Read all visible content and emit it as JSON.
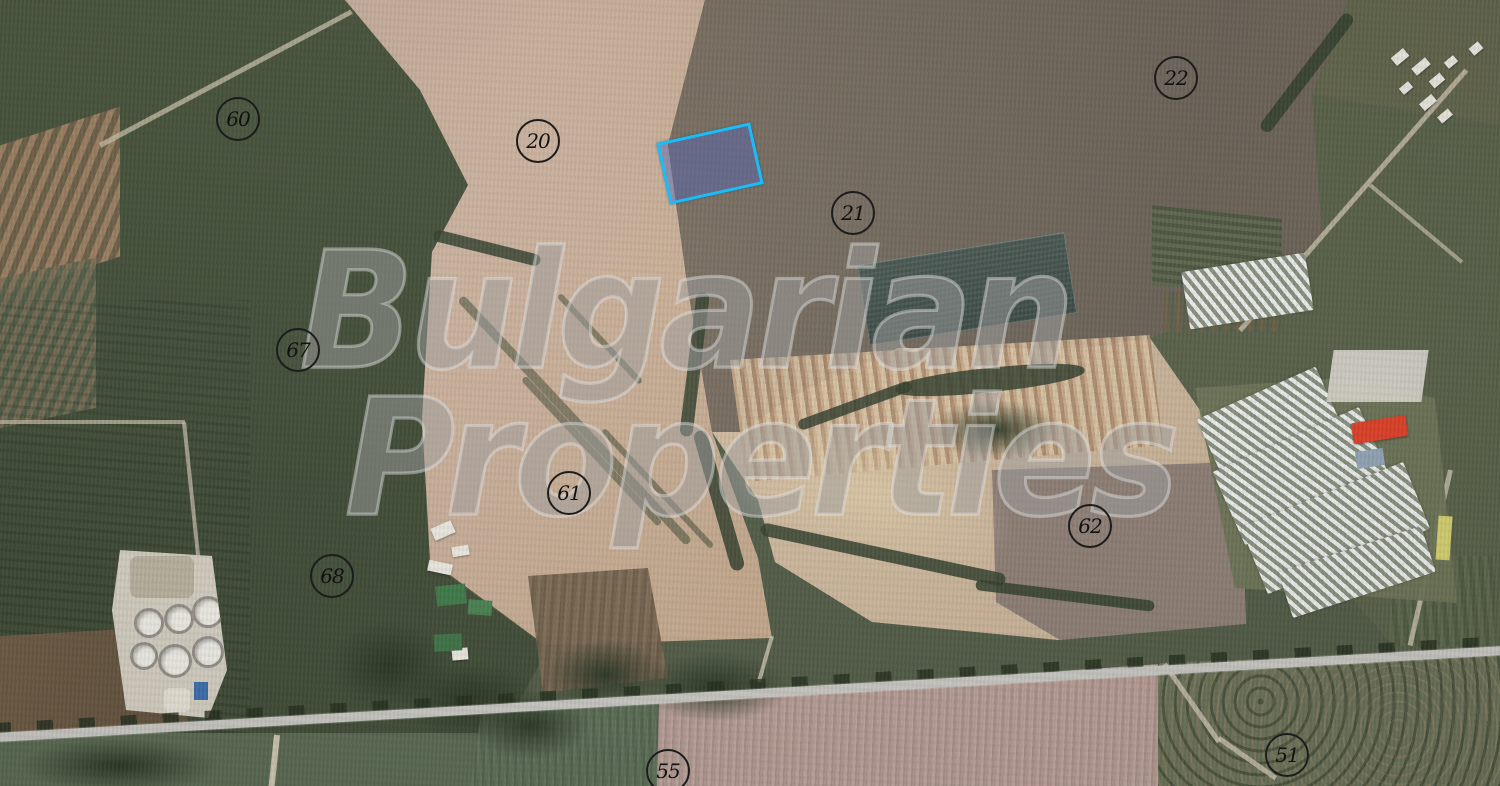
{
  "map": {
    "watermark": {
      "line1": "Bulgarian",
      "line2": "Properties"
    },
    "highlighted_parcel": {
      "outline_color": "#1bbdf6",
      "fill_color": "rgba(82,99,182,0.45)",
      "center_x": 707,
      "center_y": 160,
      "width": 90,
      "height": 57,
      "rotation_deg": -12.5
    },
    "parcels": [
      {
        "number": "60",
        "x": 237,
        "y": 118
      },
      {
        "number": "20",
        "x": 537,
        "y": 140
      },
      {
        "number": "22",
        "x": 1175,
        "y": 77
      },
      {
        "number": "21",
        "x": 852,
        "y": 212
      },
      {
        "number": "67",
        "x": 297,
        "y": 349
      },
      {
        "number": "61",
        "x": 568,
        "y": 492
      },
      {
        "number": "68",
        "x": 331,
        "y": 575
      },
      {
        "number": "62",
        "x": 1089,
        "y": 525
      },
      {
        "number": "55",
        "x": 667,
        "y": 770
      },
      {
        "number": "51",
        "x": 1286,
        "y": 754
      }
    ],
    "label_style": {
      "circle_border": "#1c1c1c",
      "text_color": "#111111"
    }
  }
}
